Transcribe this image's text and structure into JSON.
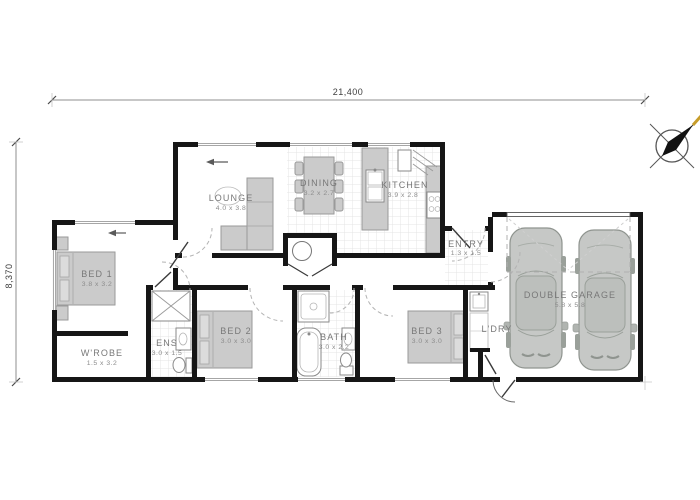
{
  "plan": {
    "type": "floor-plan",
    "dimensions": {
      "overall_width": "21,400",
      "overall_depth": "8,370"
    },
    "rooms": {
      "lounge": {
        "name": "LOUNGE",
        "size": "4.0 x 3.8"
      },
      "dining": {
        "name": "DINING",
        "size": "3.2 x 2.7"
      },
      "kitchen": {
        "name": "KITCHEN",
        "size": "3.9 x 2.8"
      },
      "entry": {
        "name": "ENTRY",
        "size": "1.3 x 1.5"
      },
      "bed1": {
        "name": "BED 1",
        "size": "3.8 x 3.2"
      },
      "wrobe": {
        "name": "W'ROBE",
        "size": "1.5 x 3.2"
      },
      "ens": {
        "name": "ENS",
        "size": "3.0 x 1.5"
      },
      "bed2": {
        "name": "BED 2",
        "size": "3.0 x 3.0"
      },
      "bath": {
        "name": "BATH",
        "size": "3.0 x 2.2"
      },
      "bed3": {
        "name": "BED 3",
        "size": "3.0 x 3.0"
      },
      "ldry": {
        "name": "L'DRY",
        "size": ""
      },
      "garage": {
        "name": "DOUBLE GARAGE",
        "size": "5.8 x 5.8"
      }
    },
    "icons": {
      "compass": "north-arrow-compass",
      "entry_arrows": "direction-arrow-left"
    },
    "colors": {
      "wall": "#161616",
      "furniture": "#cbcbcb",
      "tile_grid": "#e4e4e4",
      "label": "#787878",
      "compass_accent": "#c79d2a"
    }
  }
}
